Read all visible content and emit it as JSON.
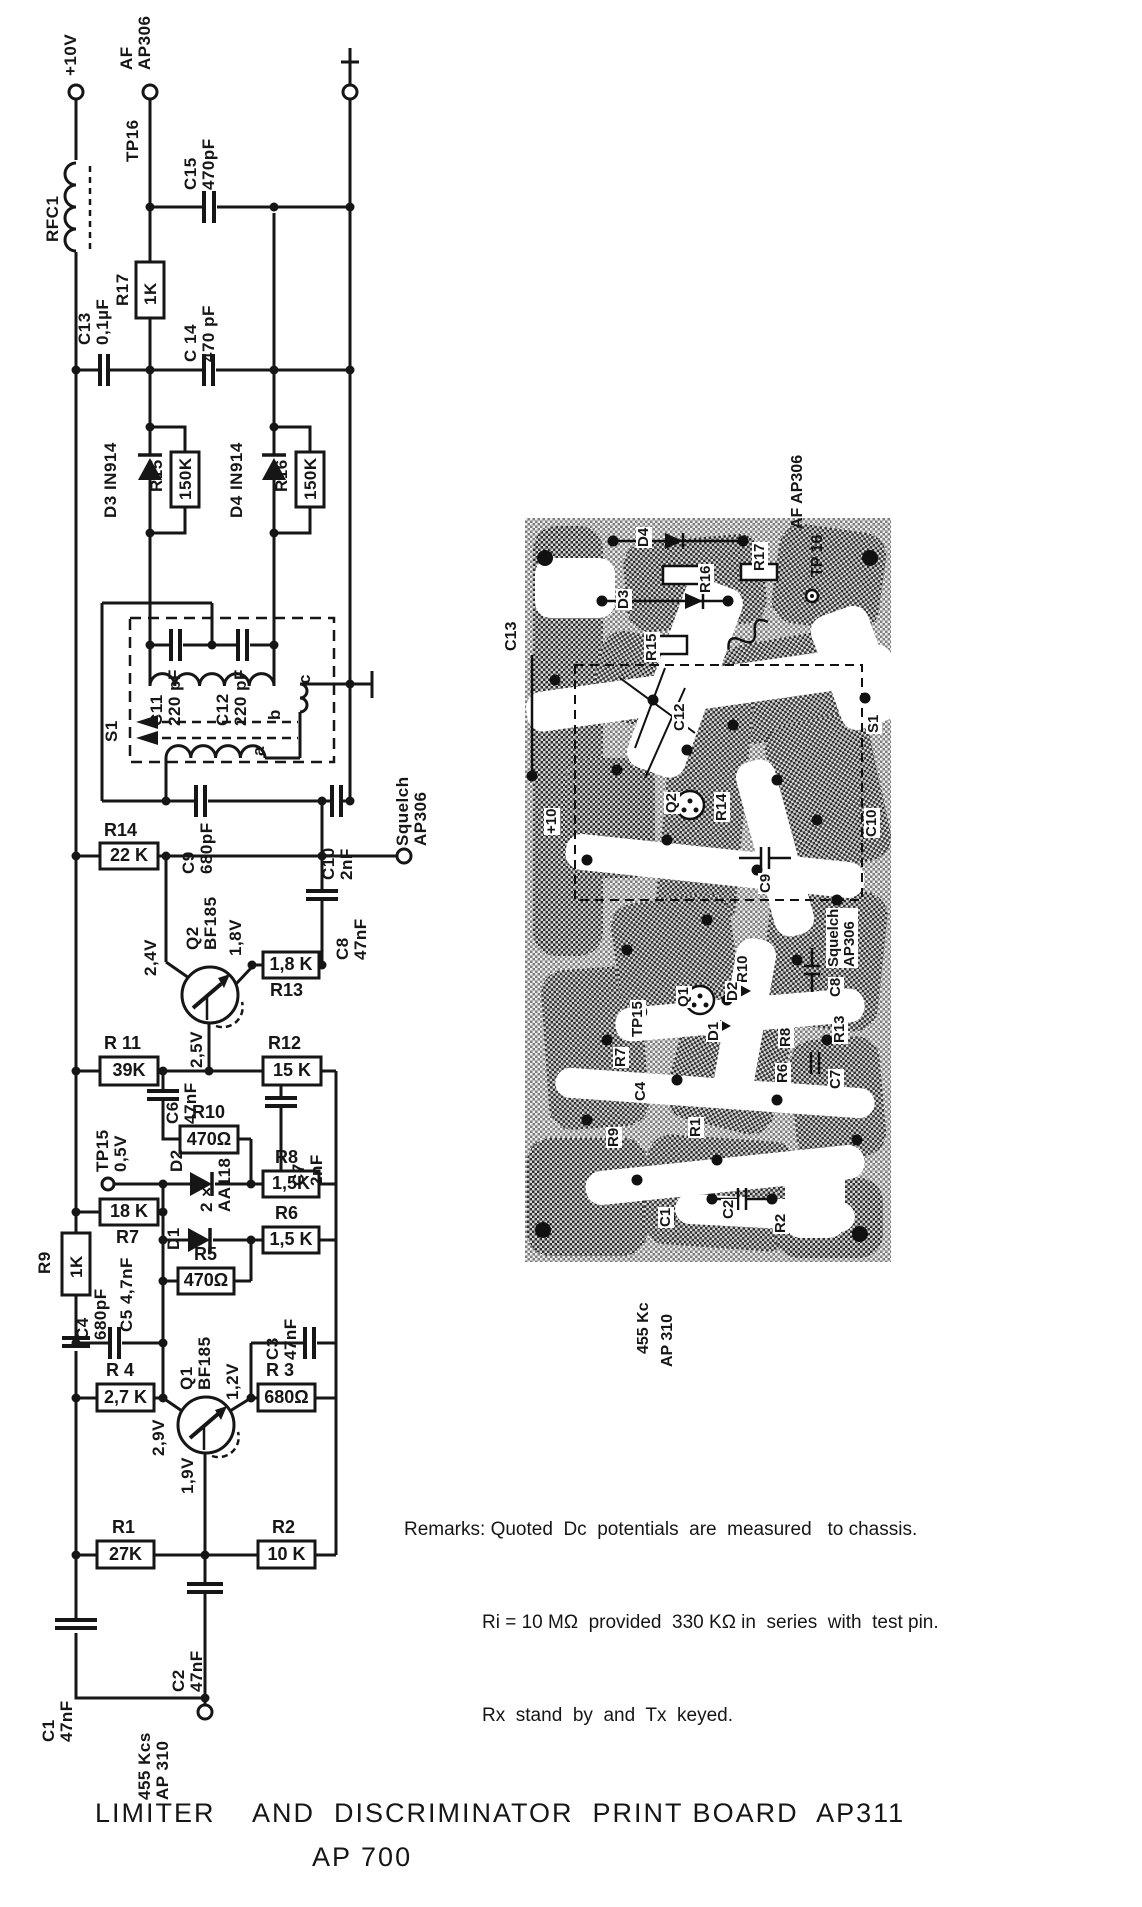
{
  "title": {
    "line1": "LIMITER    AND  DISCRIMINATOR  PRINT BOARD  AP311",
    "line2": "AP 700"
  },
  "remarks": {
    "label": "Remarks:",
    "line1": "Quoted  Dc  potentials  are  measured   to chassis.",
    "line2": "Ri = 10 MΩ  provided  330 KΩ in  series  with  test pin.",
    "line3": "Rx  stand  by  and  Tx  keyed."
  },
  "sch": {
    "plus10v": "+10V",
    "rfc1": "RFC1",
    "af": "AF\nAP306",
    "tp16": "TP16",
    "c15": "C15\n470pF",
    "r17n": "R17",
    "r17v": "1K",
    "c13": "C13\n0,1µF",
    "c14": "C 14\n470 pF",
    "d3": "D3 IN914",
    "r15n": "R15",
    "r15v": "150K",
    "d4": "D4 IN914",
    "r16n": "R16",
    "r16v": "150K",
    "s1": "S1",
    "c11": "C11\n220 pF",
    "c12": "C12\n220 pF",
    "wa": "a",
    "wb": "b",
    "wc": "c",
    "c9": "C9\n680pF",
    "c10": "C10\n2nF",
    "squelch": "Squelch\nAP306",
    "r14n": "R14",
    "r14v": "22 K",
    "q2": "Q2\nBF185",
    "v24": "2,4V",
    "v18": "1,8V",
    "v25": "2,5V",
    "r13n": "R13",
    "r13v": "1,8 K",
    "c8": "C8\n47nF",
    "r11n": "R 11",
    "r11v": "39K",
    "r12n": "R12",
    "r12v": "15 K",
    "c6": "C6\n47nF",
    "r10n": "R10",
    "r10v": "470Ω",
    "c7": "C7\n2nF",
    "tp15": "TP15\n0,5V",
    "d2": "D2",
    "aa118": "2 ×\nAA118",
    "d1": "D1",
    "r8n": "R8",
    "r8v": "1,5K",
    "r7n": "R7",
    "r7v": "18 K",
    "r6n": "R6",
    "r6v": "1,5 K",
    "r5n": "R5",
    "r5v": "470Ω",
    "r9n": "R9",
    "r9v": "1K",
    "c4": "C4\n680pF",
    "c5": "C5  4,7nF",
    "q1": "Q1\nBF185",
    "v29": "2,9V",
    "v12": "1,2V",
    "v19": "1,9V",
    "c3": "C3\n47nF",
    "r4n": "R 4",
    "r4v": "2,7 K",
    "r3n": "R 3",
    "r3v": "680Ω",
    "r1n": "R1",
    "r1v": "27K",
    "r2n": "R2",
    "r2v": "10 K",
    "c2": "C2\n47nF",
    "c1": "C1\n47nF",
    "kcs": "455 Kcs\nAP 310"
  },
  "pcb": {
    "labels": [
      {
        "text": "D4"
      },
      {
        "text": "D3"
      },
      {
        "text": "R16"
      },
      {
        "text": "R15"
      },
      {
        "text": "C13"
      },
      {
        "text": "C12"
      },
      {
        "text": "S1"
      },
      {
        "text": "C9"
      },
      {
        "text": "C10"
      },
      {
        "text": "R14"
      },
      {
        "text": "Squelch\nAP306"
      },
      {
        "text": "C8"
      },
      {
        "text": "R13"
      },
      {
        "text": "C7"
      },
      {
        "text": "R10"
      },
      {
        "text": "R8"
      },
      {
        "text": "R6"
      },
      {
        "text": "D2"
      },
      {
        "text": "D1"
      },
      {
        "text": "TP15"
      },
      {
        "text": "R7"
      },
      {
        "text": "C4"
      },
      {
        "text": "R9"
      },
      {
        "text": "R1"
      },
      {
        "text": "C2"
      },
      {
        "text": "R2"
      },
      {
        "text": "C1"
      },
      {
        "text": "Q2"
      },
      {
        "text": "Q1"
      },
      {
        "text": "AF AP306"
      },
      {
        "text": "TP 16"
      },
      {
        "text": "R17"
      },
      {
        "text": "+10"
      },
      {
        "text": "455 Kc"
      },
      {
        "text": "AP 310"
      }
    ]
  }
}
